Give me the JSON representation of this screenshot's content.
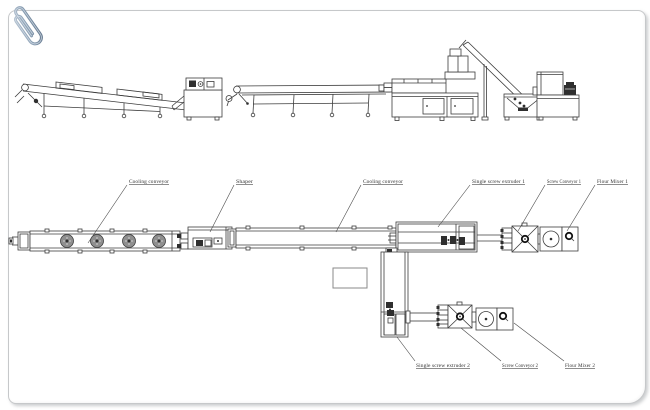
{
  "page": {
    "background_color": "#ffffff",
    "card_border_color": "#c6c8ca",
    "line_color": "#3c3c3c",
    "paperclip_colors": [
      "#b9c6d4",
      "#64788e"
    ],
    "fan_disc_color": "#8f8f8f"
  },
  "diagram": {
    "description": "Two-view engineering layout drawing of a twin extrusion production line (elevation above, plan below)",
    "labels": {
      "cooling_conveyor_1": "Cooling conveyor",
      "shaper": "Shaper",
      "cooling_conveyor_2": "Cooling conveyor",
      "single_screw_extruder_1": "Single screw extruder 1",
      "screw_conveyor_1": "Screw Conveyor 1",
      "flour_mixer_1": "Flour Mixer 1",
      "single_screw_extruder_2": "Single screw extruder 2",
      "screw_conveyor_2": "Screw Conveyor 2",
      "flour_mixer_2": "Flour Mixer 2"
    }
  }
}
